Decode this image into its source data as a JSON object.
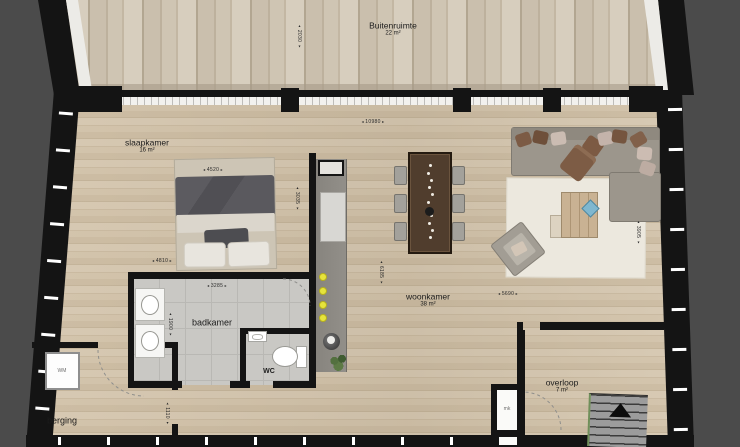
{
  "rooms": {
    "buitenruimte": {
      "name": "Buitenruimte",
      "area": "22 m²"
    },
    "slaapkamer": {
      "name": "slaapkamer",
      "area": "16 m²"
    },
    "badkamer": {
      "name": "badkamer"
    },
    "wc": {
      "name": "WC"
    },
    "woonkamer": {
      "name": "woonkamer",
      "area": "38 m²"
    },
    "overloop": {
      "name": "overloop",
      "area": "7 m²"
    },
    "berging": {
      "name": "berging"
    }
  },
  "fixtures": {
    "washing_machine": "WM",
    "meter_closet": "mk"
  },
  "dimensions_mm": {
    "deck_depth": "2030",
    "main_width": "10980",
    "bed_zone_width": "4520",
    "slaapkamer_depth": "3035",
    "slaapkamer_width": "4810",
    "badkamer_width": "3285",
    "badkamer_depth": "1900",
    "kitchen_wall_length": "6185",
    "woonkamer_width": "5690",
    "woonkamer_depth": "3905",
    "berging_passage": "1110"
  },
  "colors": {
    "outside": "#4b4b4b",
    "wall": "#141414",
    "deck_wood": "#cbc0ad",
    "interior_wood": "#d5c7b0",
    "bathroom_tile": "#c8c7c3",
    "kitchen_counter": "#8d8a84",
    "burner_yellow": "#e6e33c",
    "sofa": "#9b958b",
    "rug": "#ebe7dd",
    "dining_table": "#4f3c2c",
    "stairs": "#9a9a9a"
  }
}
